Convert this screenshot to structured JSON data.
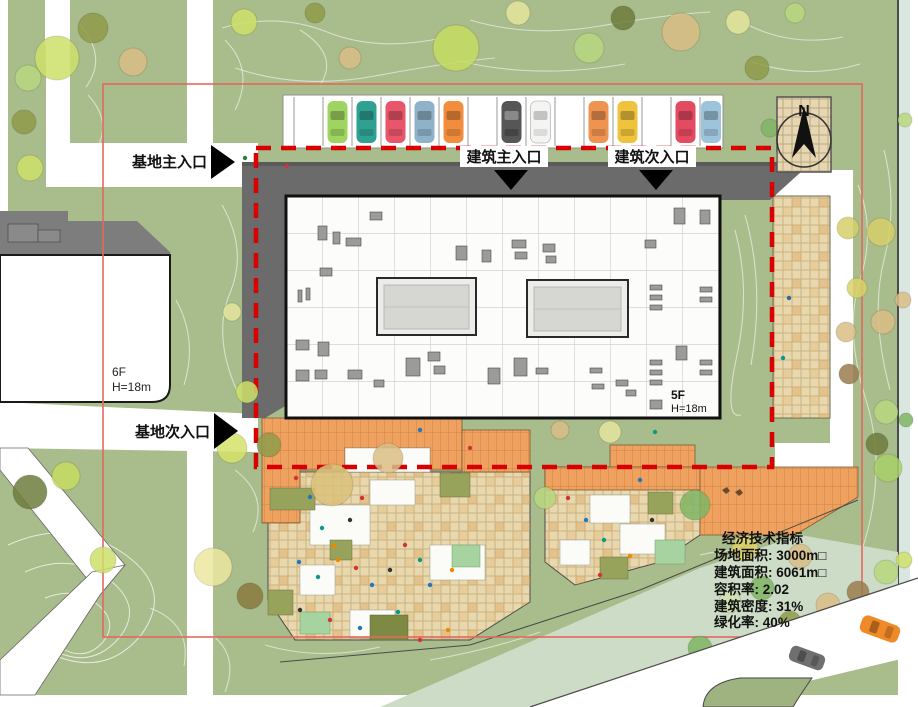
{
  "labels": {
    "site_main_entrance": "基地主入口",
    "site_secondary_entrance": "基地次入口",
    "building_main_entrance": "建筑主入口",
    "building_secondary_entrance": "建筑次入口"
  },
  "buildings": {
    "adjacent": {
      "floors": "6F",
      "height": "H=18m"
    },
    "main": {
      "floors": "5F",
      "height": "H=18m"
    }
  },
  "compass": {
    "north_label": "N"
  },
  "indicators": {
    "title": "经济技术指标",
    "lines": [
      "场地面积: 3000m□",
      "建筑面积: 6061m□",
      "容积率: 2.02",
      "建筑密度: 31%",
      "绿化率: 40%"
    ]
  },
  "parking": {
    "cars": [
      {
        "color": "#9ed45f"
      },
      {
        "color": "#2fa193"
      },
      {
        "color": "#e9566b"
      },
      {
        "color": "#8fb2c9"
      },
      {
        "color": "#f28d3d"
      },
      {
        "color": "#565656"
      },
      {
        "color": "#f4f4f2"
      },
      {
        "color": "#ef9350"
      },
      {
        "color": "#efc33c"
      },
      {
        "color": "#e54b60"
      },
      {
        "color": "#9ec4dc"
      }
    ]
  },
  "vehicles": {
    "road_cars": [
      {
        "color": "#f08a28"
      },
      {
        "color": "#6f6f6f"
      }
    ]
  },
  "colors": {
    "boundary_dashed_red": "#d80000",
    "site_red_line": "#e2695e",
    "road_gray": "#6b6b6b",
    "grass_green": "#a9bc8c",
    "plaza_orange": "#efa25f",
    "plaza_tan": "#e9d8ae"
  }
}
